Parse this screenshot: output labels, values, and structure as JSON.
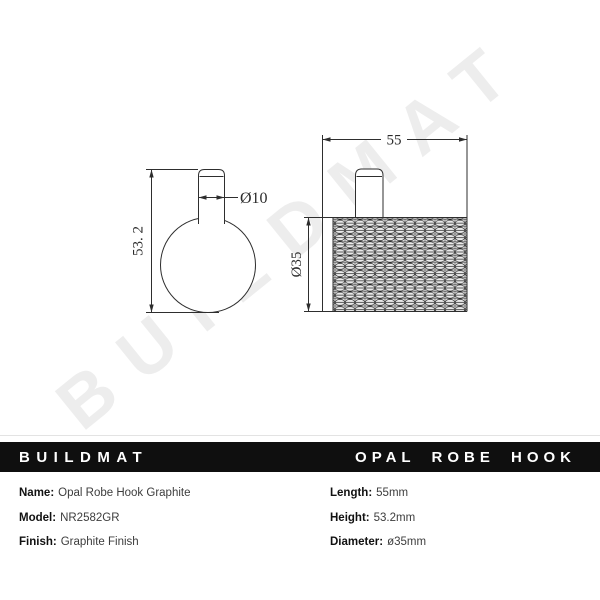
{
  "watermark": "BUILDMAT",
  "drawing": {
    "front_view": {
      "height_dim": "53. 2",
      "pin_diameter_dim": "Ø10"
    },
    "side_view": {
      "length_dim": "55",
      "body_diameter_dim": "Ø35"
    }
  },
  "banner": {
    "brand": "BUILDMAT",
    "product": "OPAL ROBE HOOK"
  },
  "specs": {
    "left": [
      {
        "label": "Name:",
        "value": "Opal Robe Hook Graphite"
      },
      {
        "label": "Model:",
        "value": "NR2582GR"
      },
      {
        "label": "Finish:",
        "value": "Graphite Finish"
      }
    ],
    "right": [
      {
        "label": "Length:",
        "value": "55mm"
      },
      {
        "label": "Height:",
        "value": "53.2mm"
      },
      {
        "label": "Diameter:",
        "value": "ø35mm"
      }
    ]
  },
  "colors": {
    "banner_bg": "#0f0f0f",
    "line": "#2e2e2e",
    "watermark": "#ededed",
    "label_text": "#111111",
    "value_text": "#3d3d3d"
  }
}
